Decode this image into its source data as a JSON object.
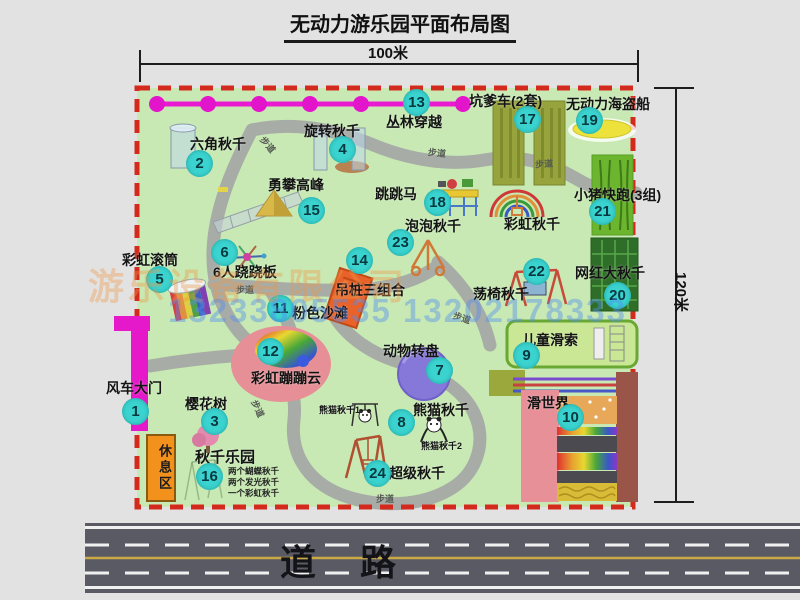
{
  "title": "无动力游乐园平面布局图",
  "dimensions": {
    "width_label": "100米",
    "height_label": "120米"
  },
  "road": {
    "label": "道路"
  },
  "rest_area_label": "休息区",
  "walkway_label": "步道",
  "rainbow_swing_label": "彩虹秋千",
  "panda_swing_1": "熊猫秋千1",
  "panda_swing_2": "熊猫秋千2",
  "swing_park_details": [
    "两个蝴蝶秋千",
    "两个发光秋千",
    "一个彩虹秋千"
  ],
  "watermark": {
    "company": "游乐设备有限公司",
    "phone": "13233805535 13202178333"
  },
  "items": [
    {
      "num": "1",
      "label": "风车大门"
    },
    {
      "num": "2",
      "label": "六角秋千"
    },
    {
      "num": "3",
      "label": "樱花树"
    },
    {
      "num": "4",
      "label": "旋转秋千"
    },
    {
      "num": "5",
      "label": "彩虹滚筒"
    },
    {
      "num": "6",
      "label": "6人跷跷板"
    },
    {
      "num": "7",
      "label": "动物转盘"
    },
    {
      "num": "8",
      "label": "熊猫秋千"
    },
    {
      "num": "9",
      "label": "儿童滑索"
    },
    {
      "num": "10",
      "label": "滑世界"
    },
    {
      "num": "11",
      "label": "粉色沙滩"
    },
    {
      "num": "12",
      "label": "彩虹蹦蹦云"
    },
    {
      "num": "13",
      "label": "丛林穿越"
    },
    {
      "num": "14",
      "label": "吊桩三组合"
    },
    {
      "num": "15",
      "label": "勇攀高峰"
    },
    {
      "num": "16",
      "label": "秋千乐园"
    },
    {
      "num": "17",
      "label": "坑爹车(2套)"
    },
    {
      "num": "18",
      "label": "跳跳马"
    },
    {
      "num": "19",
      "label": "无动力海盗船"
    },
    {
      "num": "20",
      "label": "网红大秋千"
    },
    {
      "num": "21",
      "label": "小猪快跑(3组)"
    },
    {
      "num": "22",
      "label": "荡椅秋千"
    },
    {
      "num": "23",
      "label": "泡泡秋千"
    },
    {
      "num": "24",
      "label": "超级秋千"
    }
  ],
  "colors": {
    "park_green": "#c8e9b4",
    "border_red": "#d42a1e",
    "badge_teal": "#3bd3cf",
    "gate_magenta": "#e519c9",
    "road_gray": "#5a5a64",
    "rest_orange": "#f2921d"
  }
}
